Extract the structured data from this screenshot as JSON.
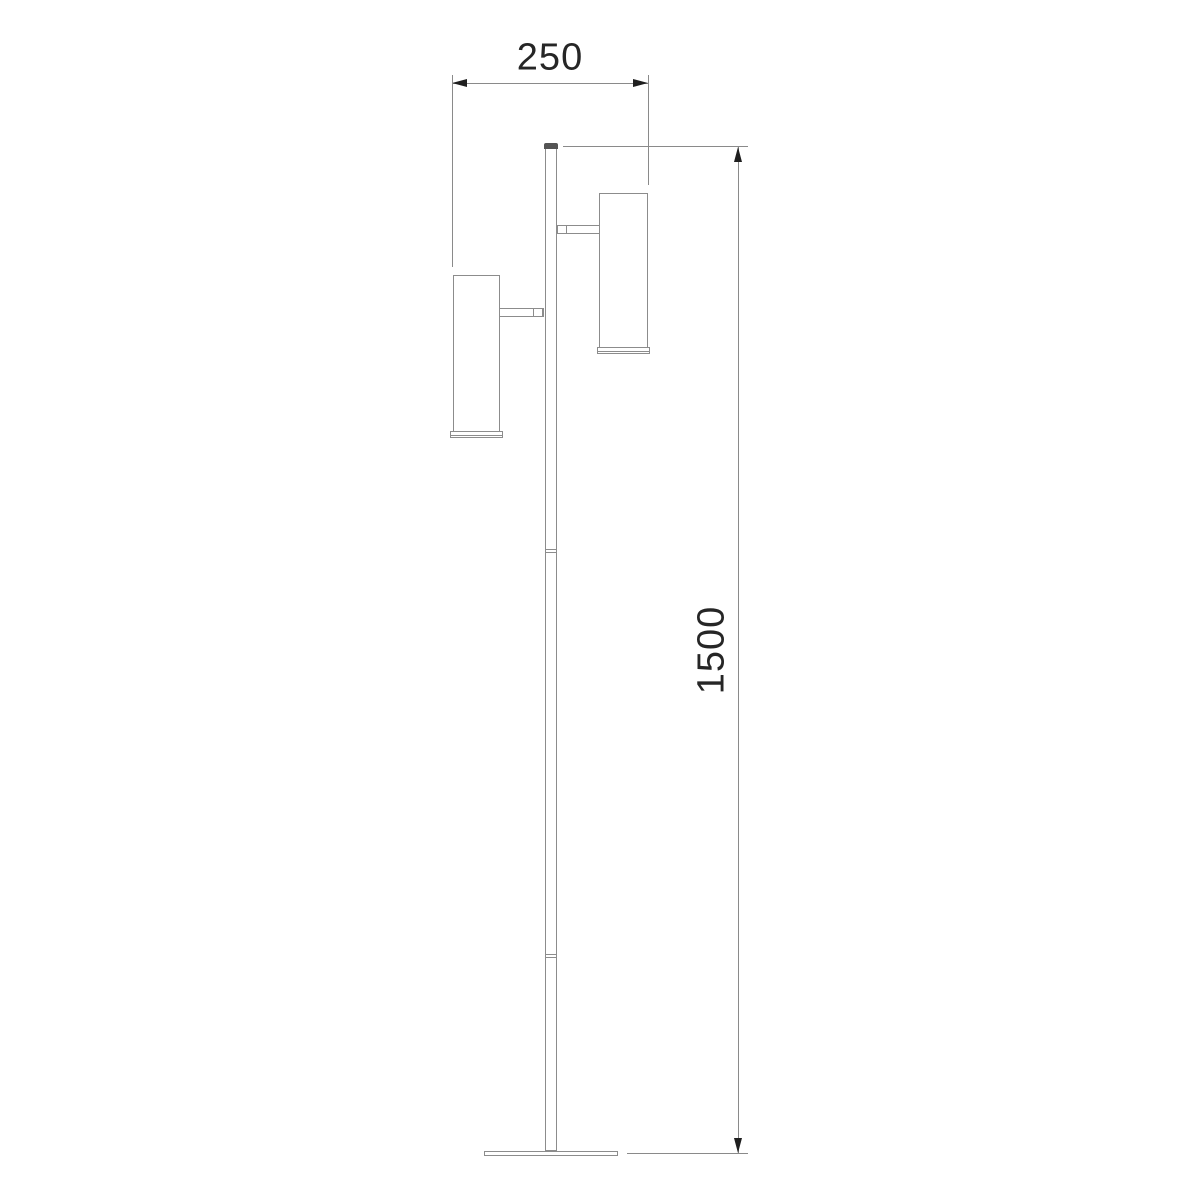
{
  "drawing": {
    "type": "technical-dimension-drawing",
    "subject": "Two-head spotlight floor lamp, side elevation",
    "units_shown": false
  },
  "dimensions": {
    "width": {
      "value": "250",
      "orientation": "horizontal"
    },
    "height": {
      "value": "1500",
      "orientation": "vertical"
    }
  },
  "colors": {
    "bg": "#ffffff",
    "outline": "#8c8c8c",
    "dimline": "#8a8a8a",
    "arrow": "#1f1f1f",
    "text": "#262626",
    "cap": "#545454"
  }
}
